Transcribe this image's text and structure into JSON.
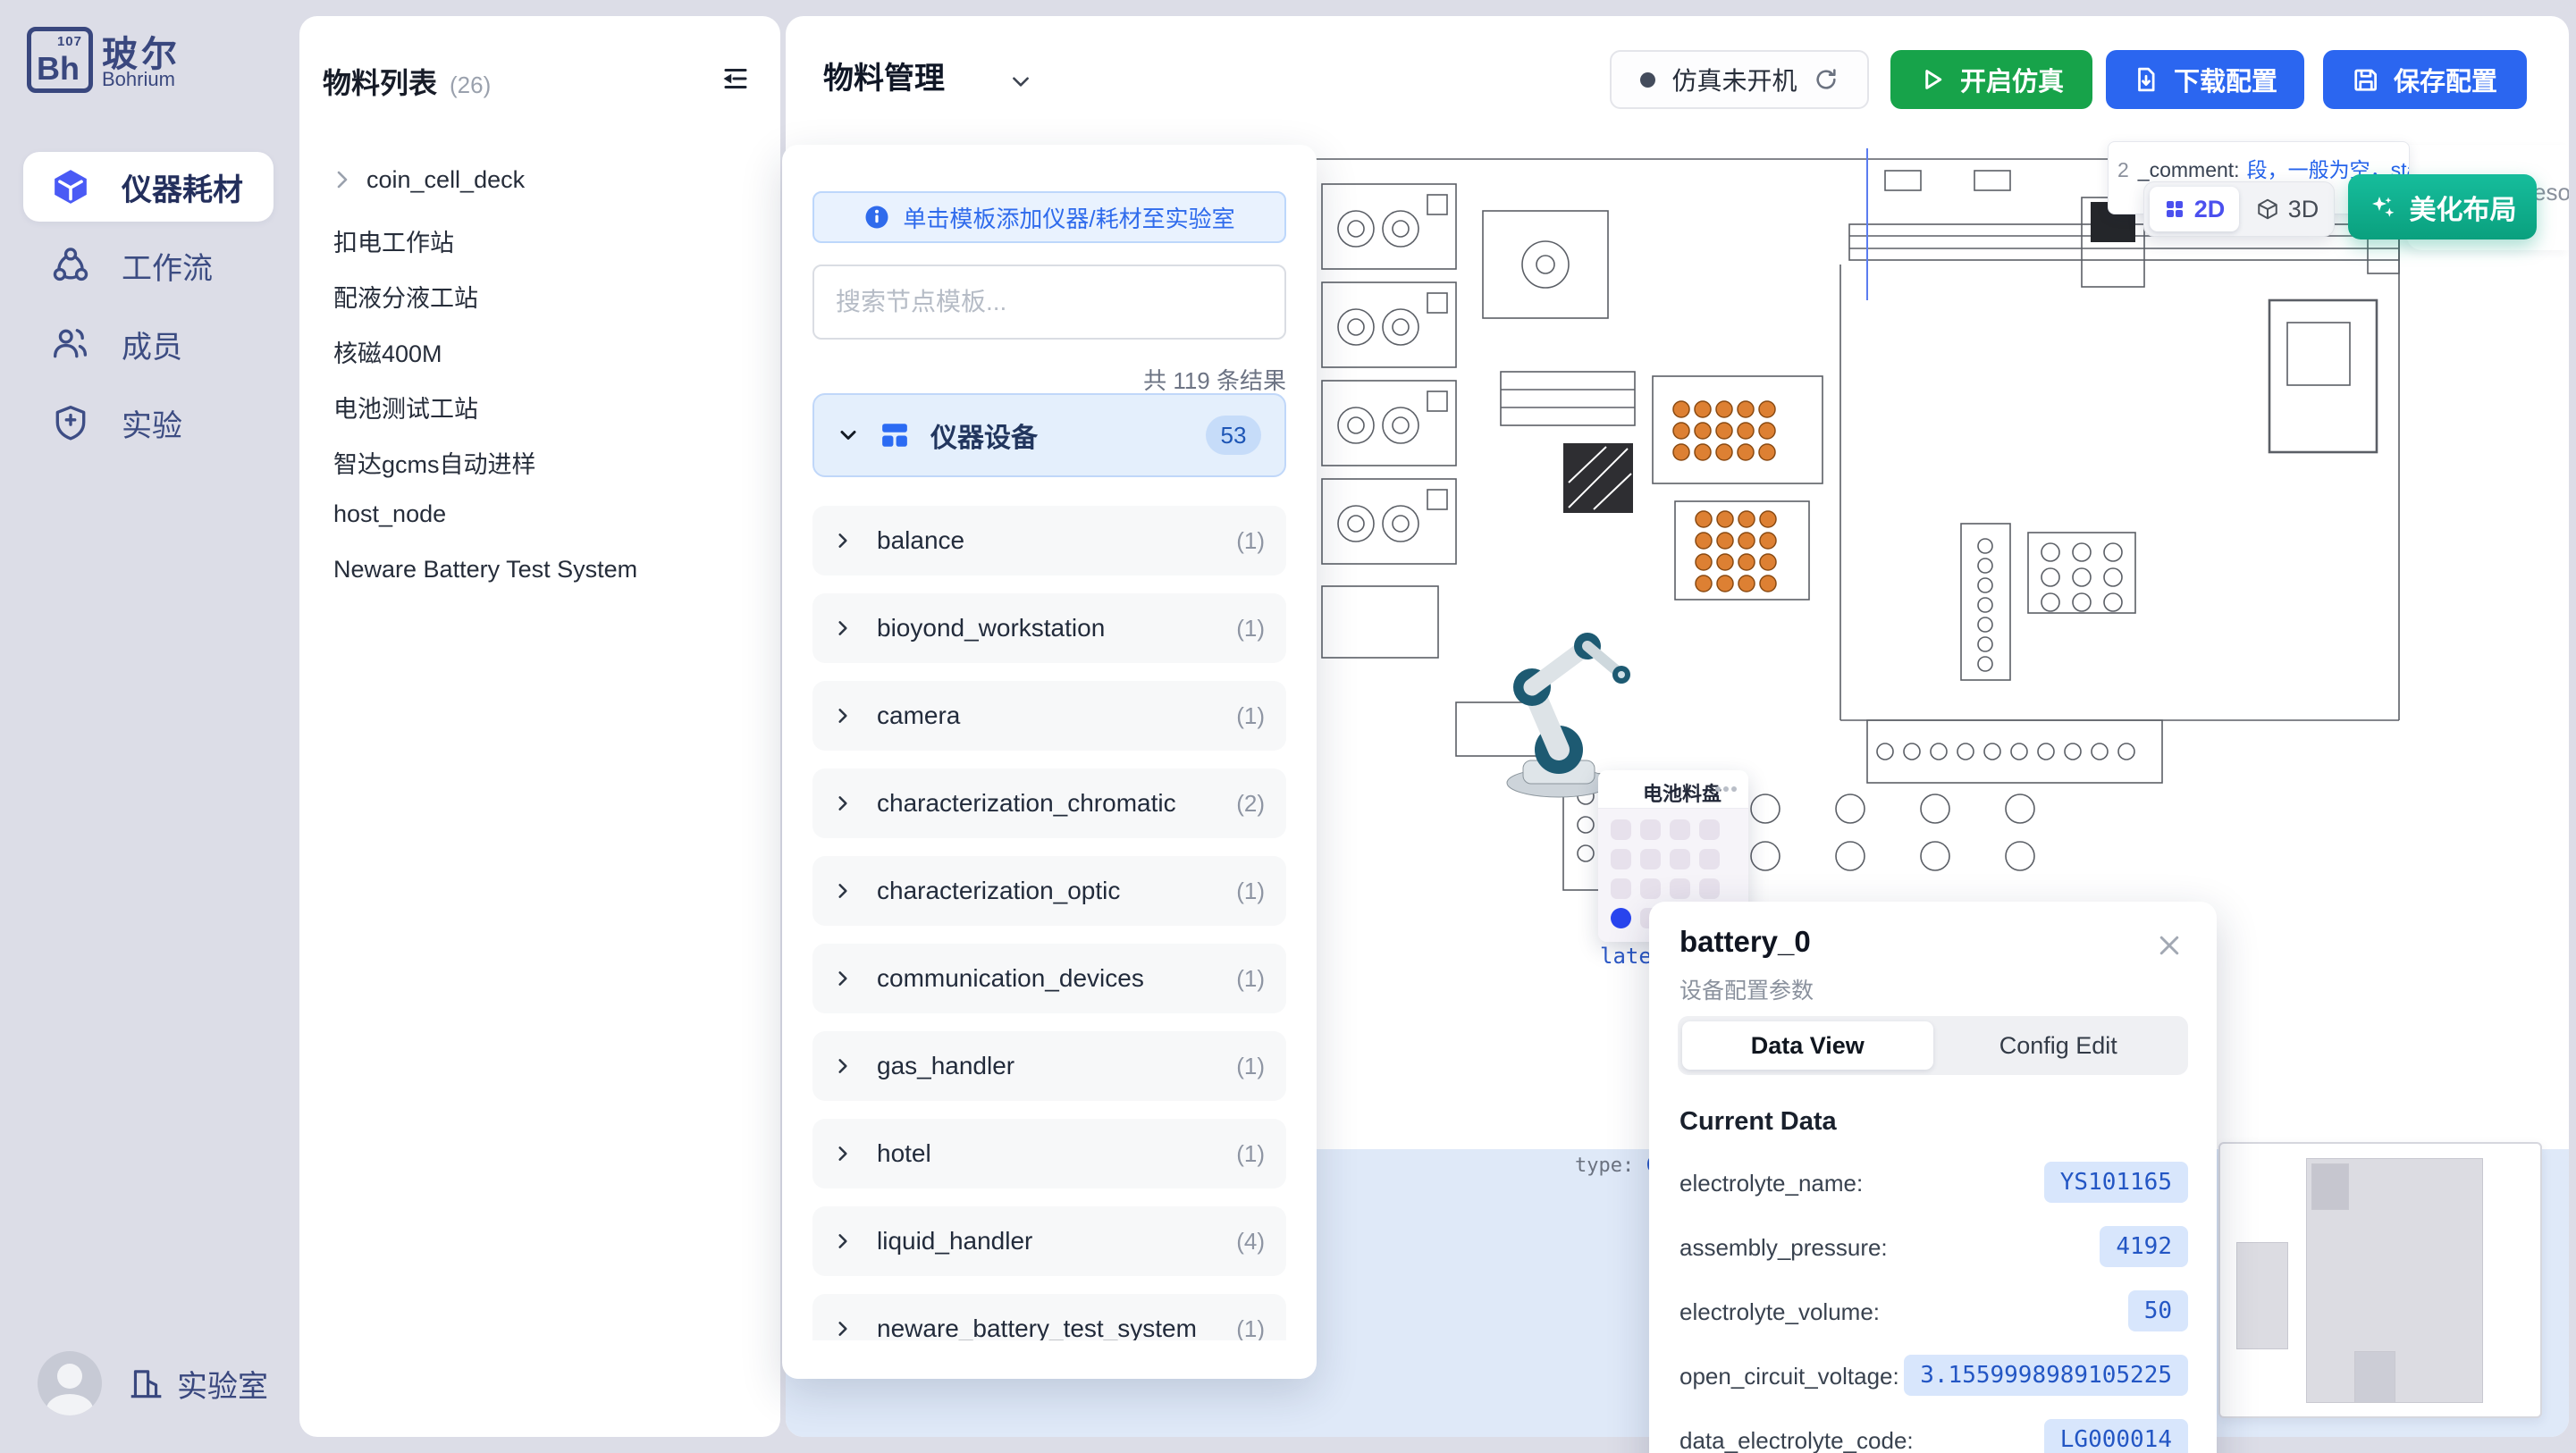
{
  "sidebar": {
    "logo": {
      "symbol": "Bh",
      "number": "107",
      "title_zh": "玻尔",
      "title_en": "Bohrium"
    },
    "items": [
      {
        "label": "仪器耗材"
      },
      {
        "label": "工作流"
      },
      {
        "label": "成员"
      },
      {
        "label": "实验"
      }
    ],
    "footer_label": "实验室"
  },
  "materials_panel": {
    "title": "物料列表",
    "count": "(26)",
    "items": [
      "coin_cell_deck",
      "扣电工作站",
      "配液分液工站",
      "核磁400M",
      "电池测试工站",
      "智达gcms自动进样",
      "host_node",
      "Neware Battery Test System"
    ]
  },
  "topbar": {
    "title": "物料管理",
    "sim_status": "仿真未开机",
    "start_sim": "开启仿真",
    "download": "下载配置",
    "save": "保存配置"
  },
  "template_panel": {
    "hint": "单击模板添加仪器/耗材至实验室",
    "search_placeholder": "搜索节点模板...",
    "result_count": "共 119 条结果",
    "group": {
      "label": "仪器设备",
      "count": "53"
    },
    "categories": [
      {
        "label": "balance",
        "count": "(1)"
      },
      {
        "label": "bioyond_workstation",
        "count": "(1)"
      },
      {
        "label": "camera",
        "count": "(1)"
      },
      {
        "label": "characterization_chromatic",
        "count": "(2)"
      },
      {
        "label": "characterization_optic",
        "count": "(1)"
      },
      {
        "label": "communication_devices",
        "count": "(1)"
      },
      {
        "label": "gas_handler",
        "count": "(1)"
      },
      {
        "label": "hotel",
        "count": "(1)"
      },
      {
        "label": "liquid_handler",
        "count": "(4)"
      },
      {
        "label": "neware_battery_test_system",
        "count": "(1)"
      }
    ]
  },
  "canvas": {
    "annotation": {
      "prefix": "2",
      "key": "_comment:",
      "value": "段，一般为空，stat",
      "line2": "固定"
    },
    "fragments": {
      "resource": "esou",
      "type_label": "type: ",
      "type_value": "Coi",
      "plate": "late"
    },
    "view_toggle": {
      "d2": "2D",
      "d3": "3D"
    },
    "beautify": "美化布局",
    "tray": {
      "title": "电池料盘"
    }
  },
  "detail_panel": {
    "title": "battery_0",
    "subtitle": "设备配置参数",
    "tabs": {
      "data_view": "Data View",
      "config_edit": "Config Edit"
    },
    "section": "Current Data",
    "fields": [
      {
        "label": "electrolyte_name:",
        "value": "YS101165"
      },
      {
        "label": "assembly_pressure:",
        "value": "4192"
      },
      {
        "label": "electrolyte_volume:",
        "value": "50"
      },
      {
        "label": "open_circuit_voltage:",
        "value": "3.1559998989105225"
      },
      {
        "label": "data_electrolyte_code:",
        "value": "LG000014"
      }
    ]
  },
  "colors": {
    "accent_blue": "#2b66f0",
    "green": "#17a34a",
    "teal": "#0aa07e",
    "purple": "#4b50ee"
  }
}
